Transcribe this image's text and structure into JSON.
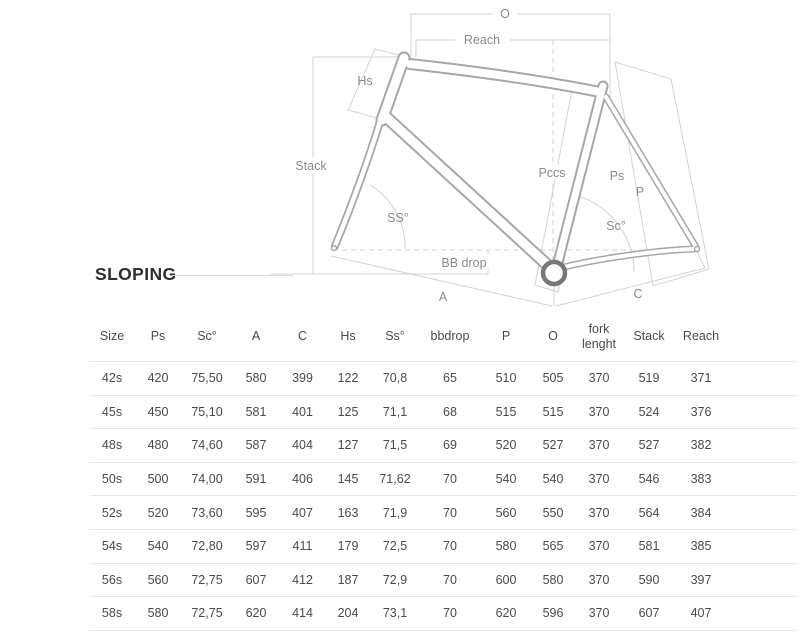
{
  "title": "SLOPING",
  "colors": {
    "title": "#2e2e2e",
    "text": "#4a4a4a",
    "divider": "#e7e7e7",
    "dline": "#d3d3d3",
    "fline": "#a3a8ab",
    "label": "#8a8a8a",
    "bbring": "#777777",
    "tline": "#dcdcdc"
  },
  "diagram": {
    "labels": {
      "o": "O",
      "reach": "Reach",
      "hs": "Hs",
      "stack": "Stack",
      "ss_angle": "SS°",
      "bb_drop": "BB drop",
      "a": "A",
      "pccs": "Pccs",
      "ps": "Ps",
      "p": "P",
      "sc_angle": "Sc°",
      "c": "C"
    }
  },
  "table": {
    "columns": [
      "Size",
      "Ps",
      "Sc°",
      "A",
      "C",
      "Hs",
      "Ss°",
      "bbdrop",
      "P",
      "O",
      "fork lenght",
      "Stack",
      "Reach"
    ],
    "rows": [
      [
        "42s",
        "420",
        "75,50",
        "580",
        "399",
        "122",
        "70,8",
        "65",
        "510",
        "505",
        "370",
        "519",
        "371"
      ],
      [
        "45s",
        "450",
        "75,10",
        "581",
        "401",
        "125",
        "71,1",
        "68",
        "515",
        "515",
        "370",
        "524",
        "376"
      ],
      [
        "48s",
        "480",
        "74,60",
        "587",
        "404",
        "127",
        "71,5",
        "69",
        "520",
        "527",
        "370",
        "527",
        "382"
      ],
      [
        "50s",
        "500",
        "74,00",
        "591",
        "406",
        "145",
        "71,62",
        "70",
        "540",
        "540",
        "370",
        "546",
        "383"
      ],
      [
        "52s",
        "520",
        "73,60",
        "595",
        "407",
        "163",
        "71,9",
        "70",
        "560",
        "550",
        "370",
        "564",
        "384"
      ],
      [
        "54s",
        "540",
        "72,80",
        "597",
        "411",
        "179",
        "72,5",
        "70",
        "580",
        "565",
        "370",
        "581",
        "385"
      ],
      [
        "56s",
        "560",
        "72,75",
        "607",
        "412",
        "187",
        "72,9",
        "70",
        "600",
        "580",
        "370",
        "590",
        "397"
      ],
      [
        "58s",
        "580",
        "72,75",
        "620",
        "414",
        "204",
        "73,1",
        "70",
        "620",
        "596",
        "370",
        "607",
        "407"
      ]
    ]
  }
}
